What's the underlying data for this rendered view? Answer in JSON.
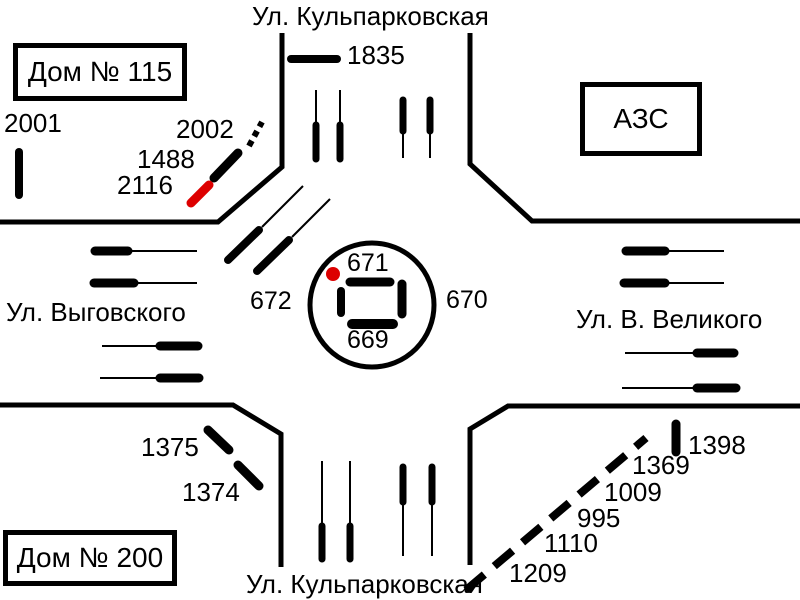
{
  "colors": {
    "ink": "#000000",
    "highlight": "#dd0000",
    "background": "#ffffff"
  },
  "streets": {
    "top": "Ул. Кульпарковская",
    "bottom": "Ул. Кульпарковская",
    "left": "Ул. Выговского",
    "right": "Ул. В. Великого"
  },
  "buildings": {
    "house_115": "Дом № 115",
    "house_200": "Дом № 200",
    "gas_station": "АЗС"
  },
  "roundabout": {
    "top": "671",
    "right": "670",
    "bottom": "669",
    "left": "672"
  },
  "markers": {
    "m2001": "2001",
    "m2002": "2002",
    "m1488": "1488",
    "m2116": "2116",
    "m1835": "1835",
    "m1375": "1375",
    "m1374": "1374",
    "m1398": "1398",
    "m1369": "1369",
    "m1009": "1009",
    "m995": "995",
    "m1110": "1110",
    "m1209": "1209"
  },
  "highlighted_markers": [
    "2116"
  ]
}
